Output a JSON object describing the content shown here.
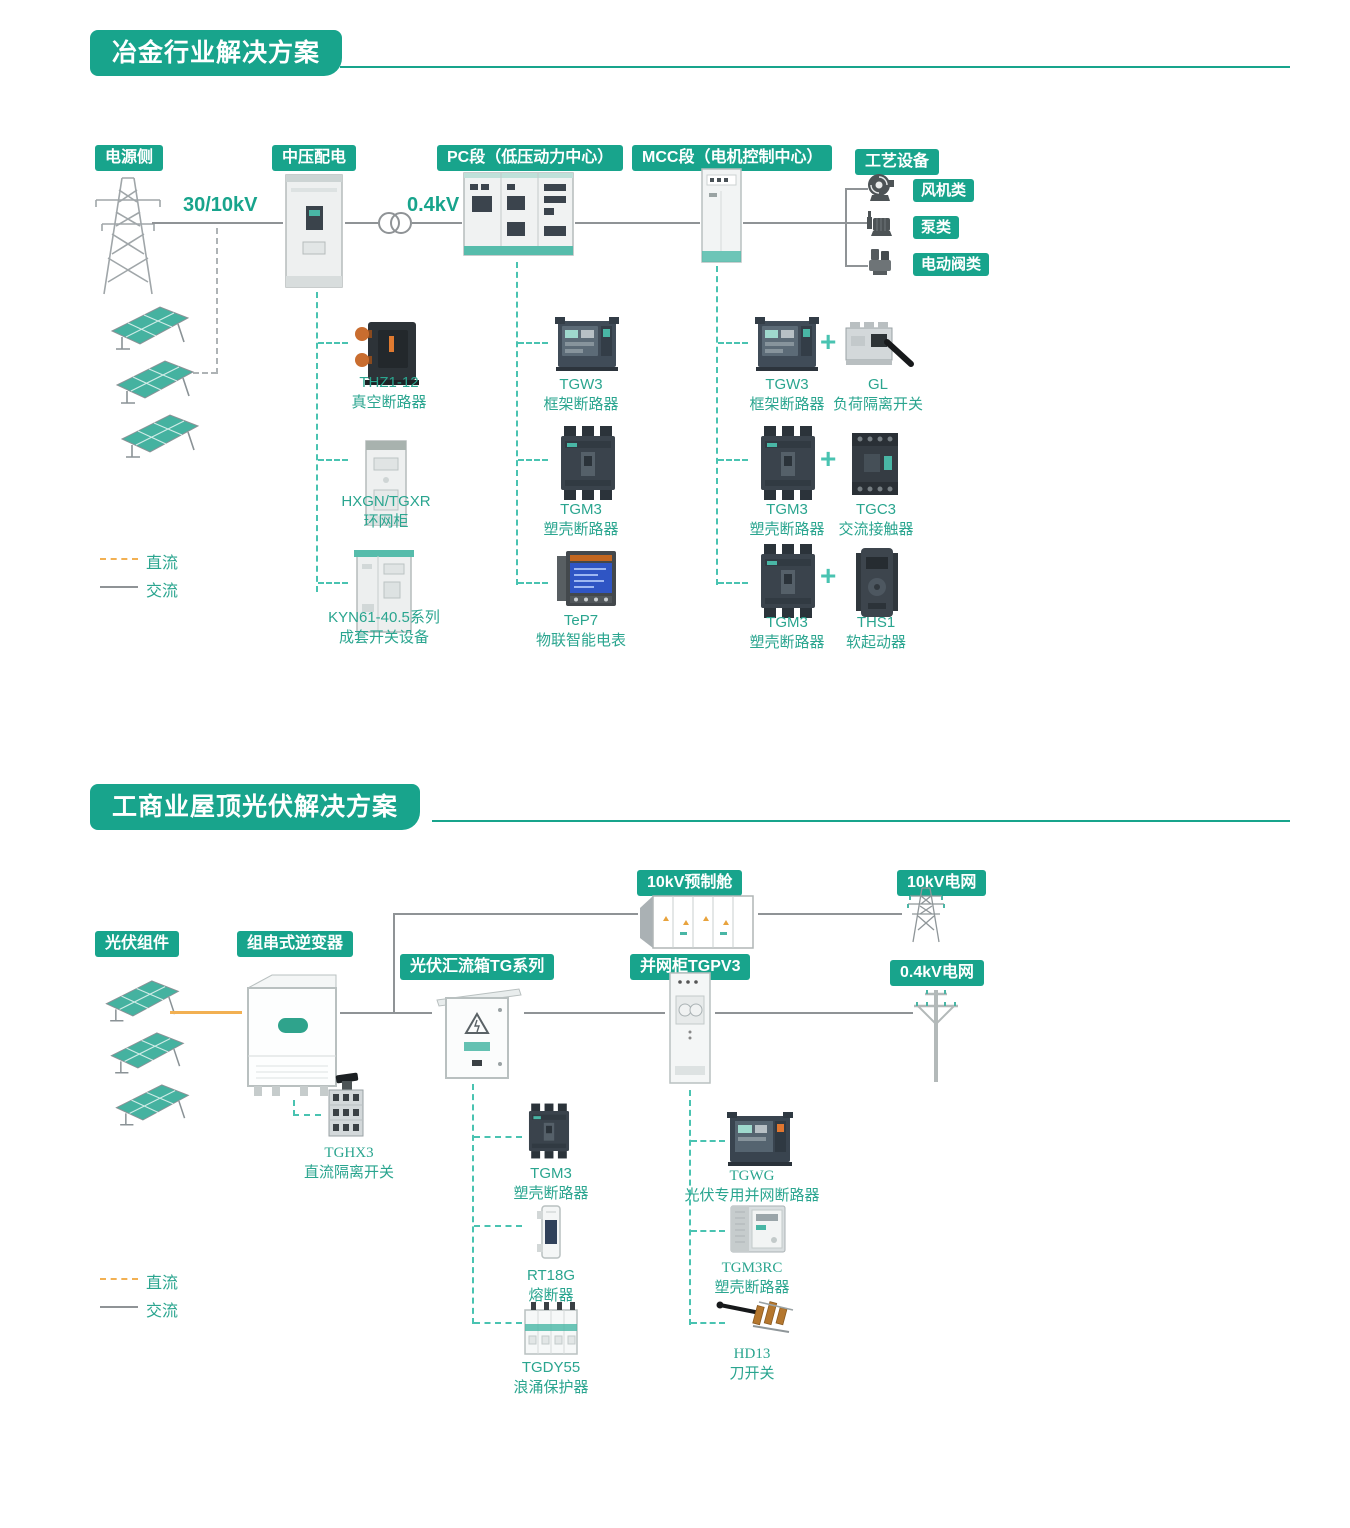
{
  "colors": {
    "brand_teal": "#18a48c",
    "dashed_connector": "#49c3b1",
    "dc_line_orange": "#f2b052",
    "ac_line_gray": "#8f9396",
    "product_label_teal": "#2aa58f"
  },
  "s1": {
    "title": "冶金行业解决方案",
    "b_power": "电源侧",
    "b_mv": "中压配电",
    "b_pc": "PC段（低压动力中心）",
    "b_mcc": "MCC段（电机控制中心）",
    "b_proc": "工艺设备",
    "v1": "30/10kV",
    "v2": "0.4kV",
    "d_fan": "风机类",
    "d_pump": "泵类",
    "d_valve": "电动阀类",
    "plus": "+",
    "thz1": {
      "m": "THZ1-12",
      "n": "真空断路器"
    },
    "hxgn": {
      "m": "HXGN/TGXR",
      "n": "环网柜"
    },
    "kyn": {
      "m": "KYN61-40.5系列",
      "n": "成套开关设备"
    },
    "tgw3_pc": {
      "m": "TGW3",
      "n": "框架断路器"
    },
    "tgm3_pc": {
      "m": "TGM3",
      "n": "塑壳断路器"
    },
    "tep7": {
      "m": "TeP7",
      "n": "物联智能电表"
    },
    "tgw3_mcc": {
      "m": "TGW3",
      "n": "框架断路器"
    },
    "gl": {
      "m": "GL",
      "n": "负荷隔离开关"
    },
    "tgm3_mcc": {
      "m": "TGM3",
      "n": "塑壳断路器"
    },
    "tgc3": {
      "m": "TGC3",
      "n": "交流接触器"
    },
    "tgm3_mcc2": {
      "m": "TGM3",
      "n": "塑壳断路器"
    },
    "ths1": {
      "m": "THS1",
      "n": "软起动器"
    },
    "leg_dc": "直流",
    "leg_ac": "交流"
  },
  "s2": {
    "title": "工商业屋顶光伏解决方案",
    "b_pv": "光伏组件",
    "b_inv": "组串式逆变器",
    "b_comb": "光伏汇流箱TG系列",
    "b_gridcab": "并网柜TGPV3",
    "b_cabin": "10kV预制舱",
    "b_g10": "10kV电网",
    "b_g04": "0.4kV电网",
    "tghx3": {
      "m": "TGHX3",
      "n": "直流隔离开关"
    },
    "tgm3": {
      "m": "TGM3",
      "n": "塑壳断路器"
    },
    "rt18g": {
      "m": "RT18G",
      "n": "熔断器"
    },
    "tgdy55": {
      "m": "TGDY55",
      "n": "浪涌保护器"
    },
    "tgwg": {
      "m": "TGWG",
      "n": "光伏专用并网断路器"
    },
    "tgm3rc": {
      "m": "TGM3RC",
      "n": "塑壳断路器"
    },
    "hd13": {
      "m": "HD13",
      "n": "刀开关"
    },
    "leg_dc": "直流",
    "leg_ac": "交流"
  }
}
